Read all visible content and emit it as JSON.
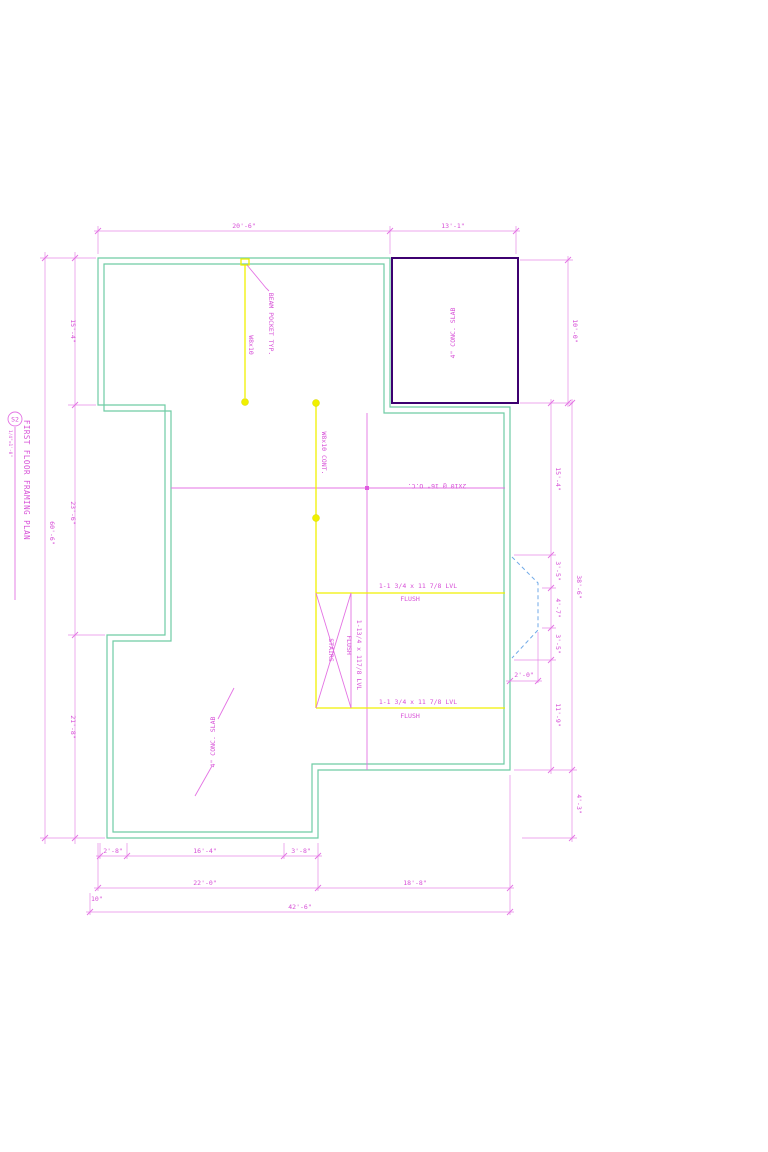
{
  "sheet": {
    "title_block": {
      "sheet_no": "S2",
      "title": "FIRST FLOOR FRAMING PLAN",
      "scale": "1/4\"=1'-0\""
    },
    "colors": {
      "dimension_magenta": "#d74fd7",
      "wall_green": "#6fcca5",
      "beam_yellow": "#f0f000",
      "slab_purple": "#3d0070",
      "bay_blue": "#70aae8"
    },
    "labels": {
      "beam_pocket": "BEAM POCKET TYP.",
      "beam_size": "W8x10",
      "beam_size_cont": "W8x10 CONT.",
      "joist_callout": "2x10 @ 16\" O.C.",
      "lvl_beam_top": "1-1 3/4 x 11 7/8 LVL",
      "lvl_beam_top_flush": "FLUSH",
      "lvl_beam_bottom": "1-1 3/4 x 11 7/8 LVL",
      "lvl_beam_bottom_flush": "FLUSH",
      "stair_lvl": "1-13/4 x 117/8 LVL",
      "stair_lvl_flush": "FLUSH",
      "stairs": "STAIRS",
      "garage_slab": "4\" CONC. SLAB",
      "room_slab": "4\" CONC. SLAB"
    },
    "dimensions": {
      "top": [
        "20'-6\"",
        "13'-1\""
      ],
      "left_overall": "60'-6\"",
      "left_chain": [
        "15'-4\"",
        "23'-6\"",
        "21'-8\""
      ],
      "right_garage": "10'-0\"",
      "right_chain": [
        "15'-4\"",
        "3'-5\"",
        "4'-7\"",
        "3'-5\"",
        "11'-9\""
      ],
      "right_overall": "38'-6\"",
      "right_lower": "4'-3\"",
      "bay_depth": "2'-0\"",
      "bottom_row1": [
        "2'-8\"",
        "16'-4\"",
        "3'-8\""
      ],
      "bottom_row2": [
        "22'-0\"",
        "18'-8\""
      ],
      "bottom_offset": "10\"",
      "bottom_overall": "42'-6\""
    }
  }
}
